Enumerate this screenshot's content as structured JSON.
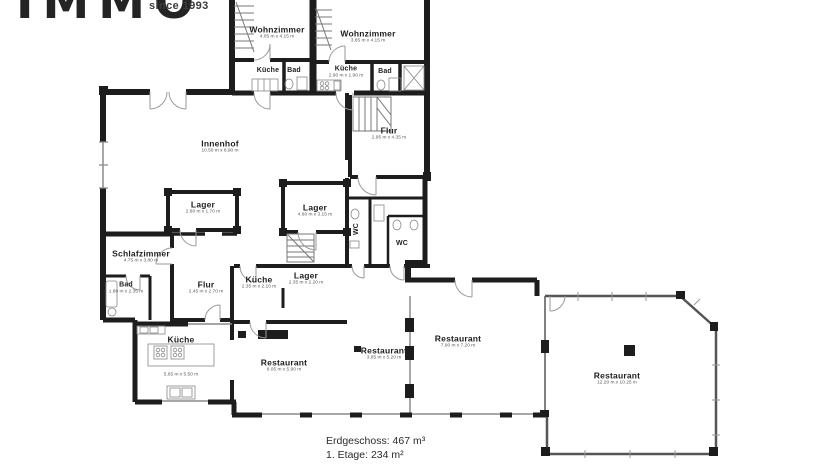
{
  "logo": {
    "brand": "IMMO",
    "tagline": "since 1993"
  },
  "rooms": {
    "wohnzimmer1": {
      "label": "Wohnzimmer",
      "dims": "4.05 m x 4.15 m"
    },
    "wohnzimmer2": {
      "label": "Wohnzimmer",
      "dims": "3.85 m x 4.15 m"
    },
    "kueche_u1": {
      "label": "Küche",
      "dims": ""
    },
    "bad_u1": {
      "label": "Bad",
      "dims": ""
    },
    "kueche_u2": {
      "label": "Küche",
      "dims": "2.90 m x 1.90 m"
    },
    "bad_u2": {
      "label": "Bad",
      "dims": ""
    },
    "flur_top": {
      "label": "Flur",
      "dims": "2.95 m x 4.35 m"
    },
    "innenhof": {
      "label": "Innenhof",
      "dims": "10.50 m x 8.90 m"
    },
    "lager1": {
      "label": "Lager",
      "dims": "2.80 m x 1.70 m"
    },
    "lager2": {
      "label": "Lager",
      "dims": "4.60 m x 3.15 m"
    },
    "schlafzimmer": {
      "label": "Schlafzimmer",
      "dims": "4.75 m x 3.80 m"
    },
    "bad2": {
      "label": "Bad",
      "dims": "1.80 m x 2.35 m"
    },
    "flur2": {
      "label": "Flur",
      "dims": "2.45 m x 2.70 m"
    },
    "kueche2": {
      "label": "Küche",
      "dims": "2.35 m x 2.10 m"
    },
    "lager3": {
      "label": "Lager",
      "dims": "2.35 m x 2.20 m"
    },
    "wc1": {
      "label": "WC",
      "dims": ""
    },
    "wc2": {
      "label": "WC",
      "dims": ""
    },
    "kueche3": {
      "label": "Küche",
      "dims": "5.65 m x 5.50 m"
    },
    "restaurant1": {
      "label": "Restaurant",
      "dims": "8.05 m x 5.90 m"
    },
    "restaurant2": {
      "label": "Restaurant",
      "dims": "3.85 m x 5.20 m"
    },
    "restaurant3": {
      "label": "Restaurant",
      "dims": "7.90 m x 7.20 m"
    },
    "restaurant4": {
      "label": "Restaurant",
      "dims": "12.20 m x 10.25 m"
    }
  },
  "plan": {
    "line1": "Erdgeschoss: 467 m³",
    "line2": "1. Etage: 234 m²"
  },
  "colors": {
    "wall": "#1d1d1d",
    "thin_line": "#8a8a8a",
    "text": "#1e1e1e",
    "dims_text": "#5a5a5a",
    "background": "#ffffff"
  }
}
